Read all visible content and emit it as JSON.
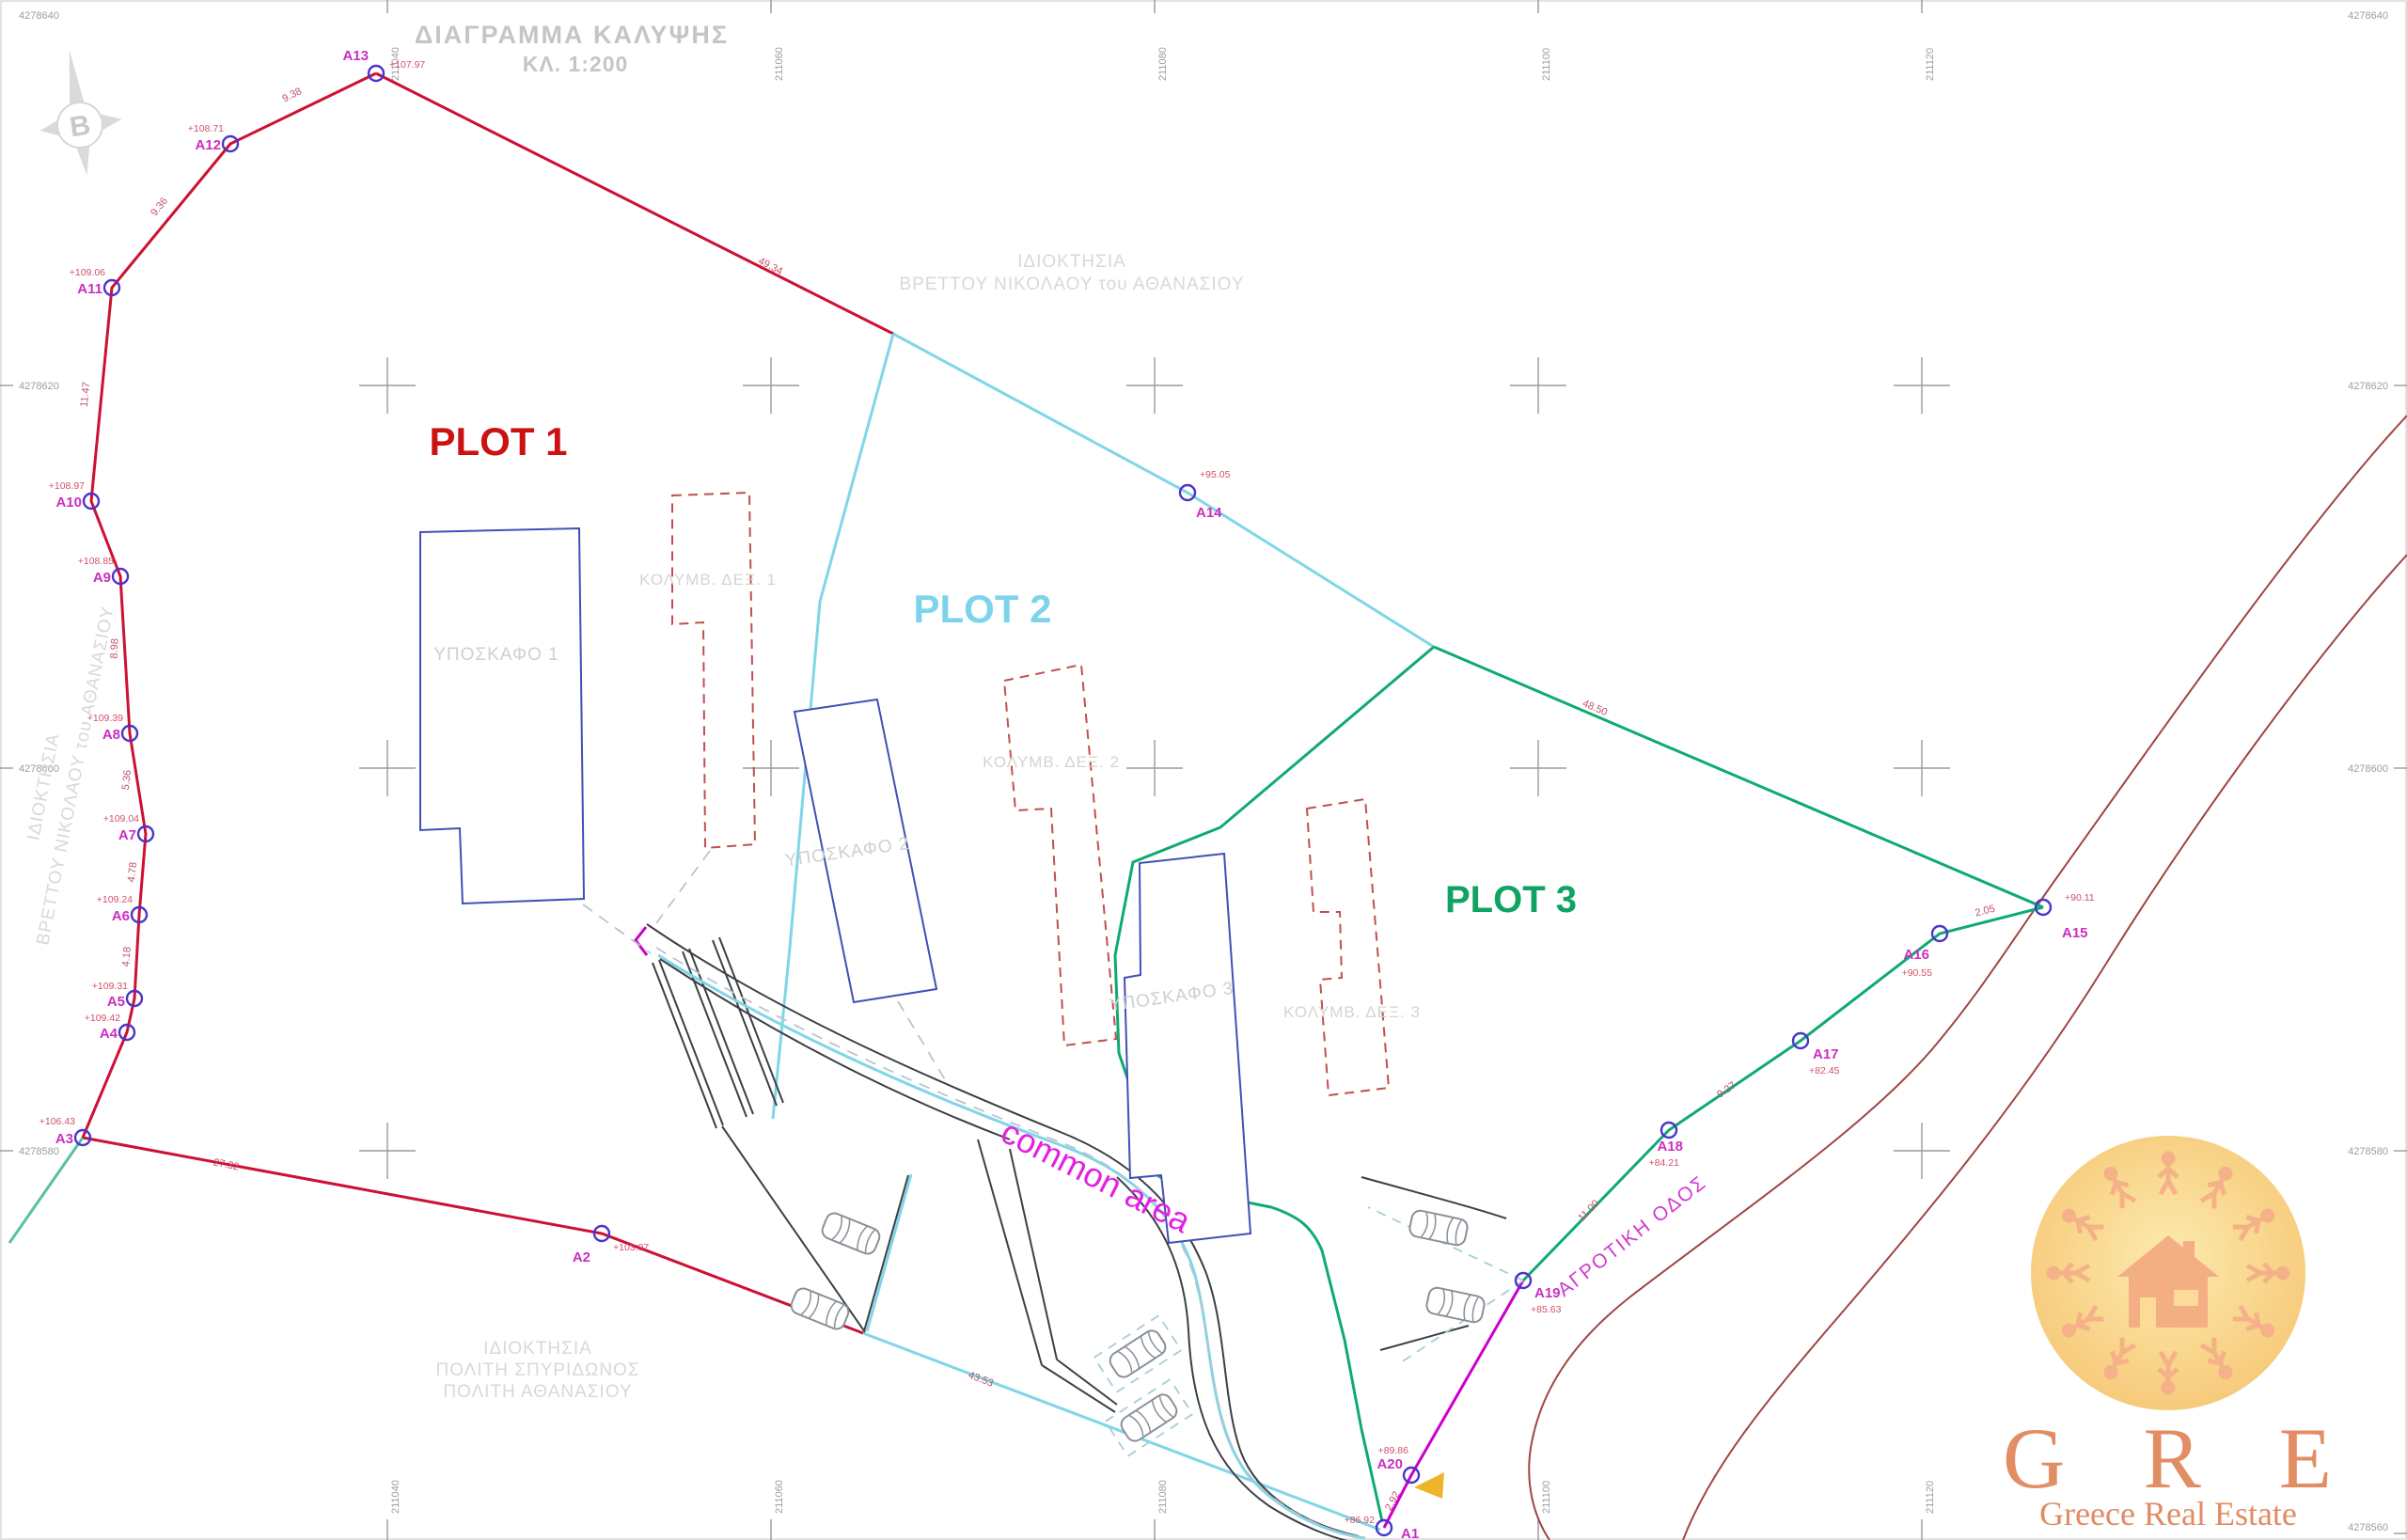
{
  "title": {
    "line1": "ΔΙΑΓΡΑΜΜΑ ΚΑΛΥΨΗΣ",
    "line2": "ΚΛ. 1:200"
  },
  "compass": {
    "letter": "B"
  },
  "neighbors": {
    "north": [
      "ΙΔΙΟΚΤΗΣΙΑ",
      "ΒΡΕΤΤΟΥ ΝΙΚΟΛΑΟΥ του ΑΘΑΝΑΣΙΟΥ"
    ],
    "west": [
      "ΙΔΙΟΚΤΗΣΙΑ",
      "ΒΡΕΤΤΟΥ ΝΙΚΟΛΑΟΥ του ΑΘΑΝΑΣΙΟΥ"
    ],
    "south": [
      "ΙΔΙΟΚΤΗΣΙΑ",
      "ΠΟΛΙΤΗ ΣΠΥΡΙΔΩΝΟΣ",
      "ΠΟΛΙΤΗ ΑΘΑΝΑΣΙΟΥ"
    ]
  },
  "plots": {
    "p1": "PLOT 1",
    "p2": "PLOT 2",
    "p3": "PLOT 3"
  },
  "areas": {
    "common": "common area",
    "road": "ΑΓΡΟΤΙΚΗ ΟΔΟΣ"
  },
  "buildings": {
    "b1": "ΥΠΟΣΚΑΦΟ 1",
    "b2": "ΥΠΟΣΚΑΦΟ 2",
    "b3": "ΥΠΟΣΚΑΦΟ 3"
  },
  "pools": {
    "p1": "ΚΟΛΥΜΒ. ΔΕΞ. 1",
    "p2": "ΚΟΛΥΜΒ. ΔΕΞ. 2",
    "p3": "ΚΟΛΥΜΒ. ΔΕΞ. 3"
  },
  "v": [
    {
      "n": "A1",
      "e": "+86.92"
    },
    {
      "n": "A2",
      "e": "+103.97"
    },
    {
      "n": "A3",
      "e": "+106.43"
    },
    {
      "n": "A4",
      "e": "+109.42"
    },
    {
      "n": "A5",
      "e": "+109.31"
    },
    {
      "n": "A6",
      "e": "+109.24"
    },
    {
      "n": "A7",
      "e": "+109.04"
    },
    {
      "n": "A8",
      "e": "+109.39"
    },
    {
      "n": "A9",
      "e": "+108.85"
    },
    {
      "n": "A10",
      "e": "+108.97"
    },
    {
      "n": "A11",
      "e": "+109.06"
    },
    {
      "n": "A12",
      "e": "+108.71"
    },
    {
      "n": "A13",
      "e": "+107.97"
    },
    {
      "n": "A14",
      "e": "+95.05"
    },
    {
      "n": "A15",
      "e": "+90.11"
    },
    {
      "n": "A16",
      "e": "+90.55"
    },
    {
      "n": "A17",
      "e": "+82.45"
    },
    {
      "n": "A18",
      "e": "+84.21"
    },
    {
      "n": "A19",
      "e": "+85.63"
    },
    {
      "n": "A20",
      "e": "+89.86"
    }
  ],
  "d": [
    "9.38",
    "9.36",
    "11.47",
    "8.98",
    "5.36",
    "4.78",
    "4.18",
    "49.34",
    "48.50",
    "2.05",
    "9.27",
    "11.00",
    "2.92",
    "27.32",
    "43.53"
  ],
  "grid": {
    "e": [
      "211040",
      "211060",
      "211080",
      "211100",
      "211120"
    ],
    "n": [
      "4278640",
      "4278620",
      "4278600",
      "4278580",
      "4278560"
    ]
  },
  "logo": {
    "initials": "G R E",
    "name": "Greece Real Estate"
  },
  "colors": {
    "plot1": "#cc1111",
    "plot2": "#7dd4ea",
    "plot3": "#10a364",
    "common": "#e321e3",
    "boundary_red": "#cc1133",
    "boundary_cyan": "#7fd6e8",
    "boundary_green": "#0faa72",
    "boundary_magenta": "#cc00cc",
    "road_brown": "#a04545",
    "logo_orange": "#e08457",
    "logo_circle": "#f8cf7d"
  }
}
